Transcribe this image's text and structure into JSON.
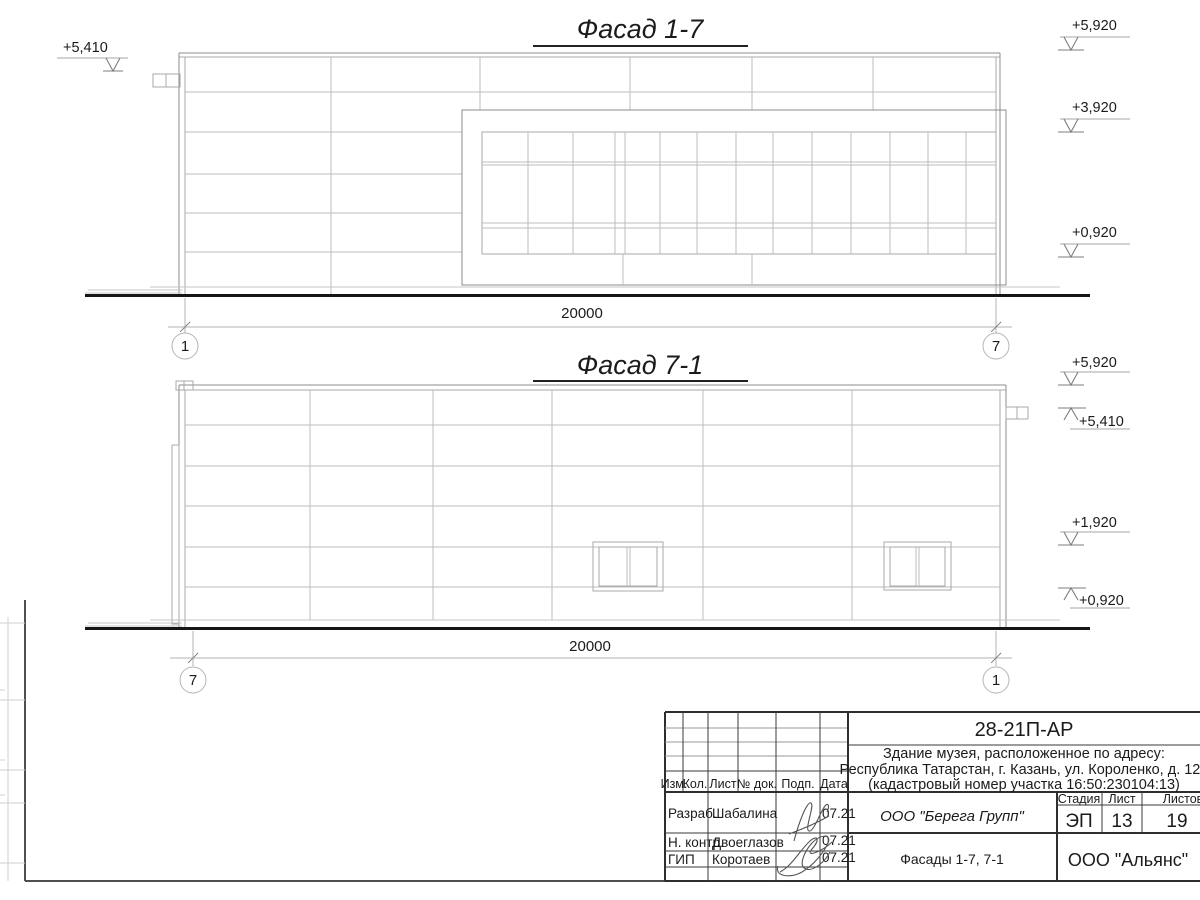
{
  "facade_top": {
    "title": "Фасад 1-7",
    "dimension": "20000",
    "axis_left": "1",
    "axis_right": "7",
    "elevation_left": "+5,410",
    "elevations_right": {
      "r1": "+5,920",
      "r2": "+3,920",
      "r3": "+0,920"
    }
  },
  "facade_bottom": {
    "title": "Фасад 7-1",
    "dimension": "20000",
    "axis_left": "7",
    "axis_right": "1",
    "elevations_right": {
      "r1": "+5,920",
      "r2": "+5,410",
      "r3": "+1,920",
      "r4": "+0,920"
    }
  },
  "title_block": {
    "doc_code": "28-21П-АР",
    "project_address_line1": "Здание музея, расположенное по адресу:",
    "project_address_line2": "Республика Татарстан, г. Казань, ул. Короленко, д. 120",
    "project_address_line3": "(кадастровый номер участка 16:50:230104:13)",
    "columns": {
      "izm": "Изм.",
      "kol": "Кол.",
      "list": "Лист",
      "doc": "№ док.",
      "podp": "Подп.",
      "data": "Дата"
    },
    "stage": {
      "label": "Стадия",
      "value": "ЭП"
    },
    "sheet": {
      "label": "Лист",
      "value": "13"
    },
    "sheets_total": {
      "label": "Листов",
      "value": "19"
    },
    "rows": {
      "razrab": {
        "role": "Разраб.",
        "name": "Шабалина",
        "date": "07.21"
      },
      "nkontr": {
        "role": "Н. контр.",
        "name": "Двоеглазов",
        "date": "07.21"
      },
      "gip": {
        "role": "ГИП",
        "name": "Коротаев",
        "date": "07.21"
      }
    },
    "designer_org": "ООО \"Берега Групп\"",
    "drawing_title": "Фасады 1-7, 7-1",
    "customer_org": "ООО \"Альянс\""
  }
}
